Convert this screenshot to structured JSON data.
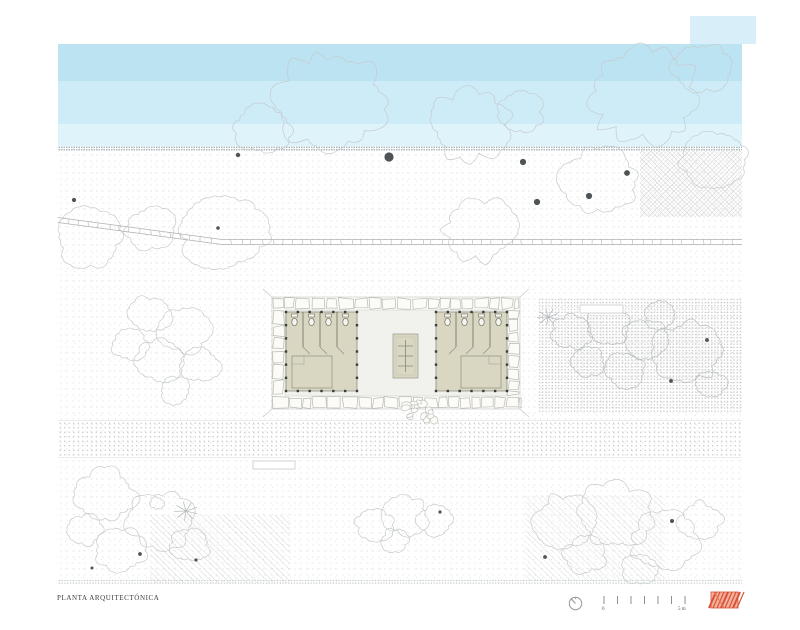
{
  "drawing": {
    "title": "PLANTA ARQUITECTÓNICA",
    "scale": {
      "zero_label": "0",
      "end_label": "5 m"
    },
    "icons": {
      "north": "north-arrow-icon",
      "stamp": "red-hatched-logo-stamp"
    }
  },
  "colors": {
    "water_deep": "#bce3f2",
    "water_mid": "#cdecf8",
    "water_shallow": "#def3fa",
    "room_floor_beige": "#d9d6c1",
    "stamp_red": "#d95237"
  }
}
